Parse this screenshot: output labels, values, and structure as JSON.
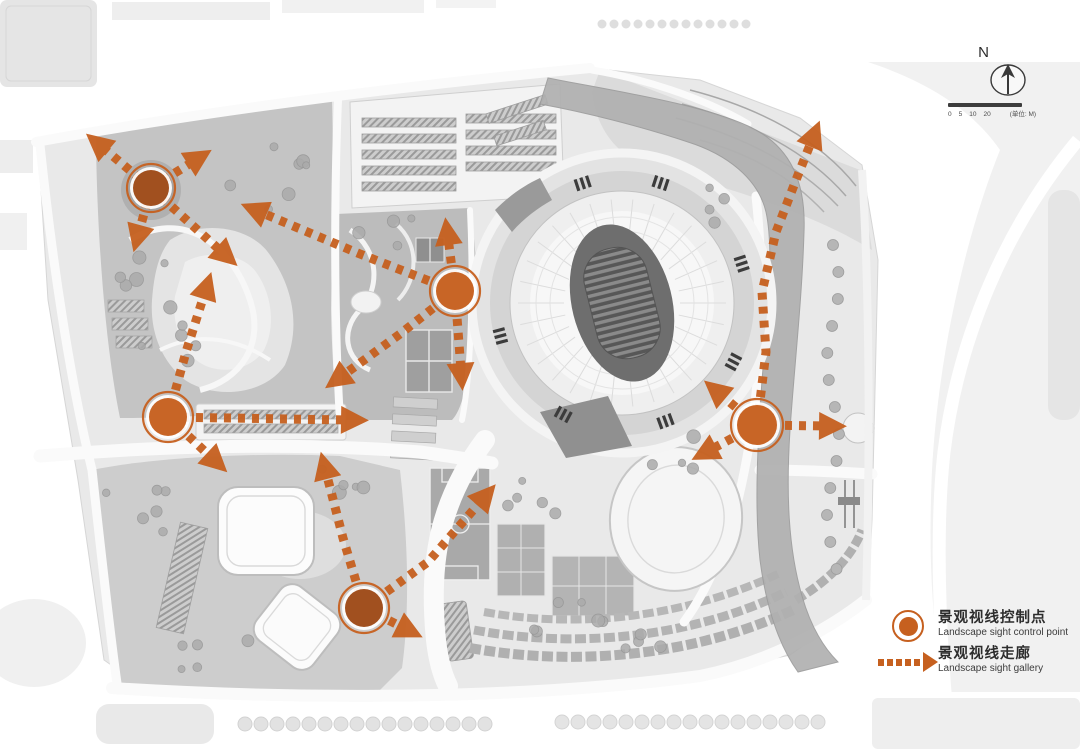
{
  "compass": {
    "north_label": "N"
  },
  "scale_bar": {
    "ticks": [
      "0",
      "5",
      "10",
      "20"
    ],
    "unit_label": "(单位: M)"
  },
  "legend": {
    "items": [
      {
        "id": "control-point",
        "symbol": "circle",
        "label_cn": "景观视线控制点",
        "label_en": "Landscape sight control point"
      },
      {
        "id": "sight-gallery",
        "symbol": "dashed-arrow",
        "label_cn": "景观视线走廊",
        "label_en": "Landscape sight gallery"
      }
    ]
  },
  "colors": {
    "accent_orange": "#c6601f",
    "accent_orange_dark": "#9e4a18",
    "map_gray": "#c8c8c8",
    "river_gray": "#b0b0b0",
    "page_bg": "#ffffff"
  },
  "map": {
    "control_points": [
      {
        "id": "CP1",
        "x": 151,
        "y": 188,
        "r": 18,
        "shade": "dark"
      },
      {
        "id": "CP2",
        "x": 455,
        "y": 291,
        "r": 19,
        "shade": "normal"
      },
      {
        "id": "CP3",
        "x": 168,
        "y": 417,
        "r": 19,
        "shade": "normal"
      },
      {
        "id": "CP4",
        "x": 364,
        "y": 608,
        "r": 19,
        "shade": "dark"
      },
      {
        "id": "CP5",
        "x": 757,
        "y": 425,
        "r": 20,
        "shade": "normal"
      }
    ],
    "sight_corridors": [
      {
        "id": "c1",
        "path": [
          [
            151,
            188
          ],
          [
            102,
            147
          ]
        ],
        "arrow_end": true
      },
      {
        "id": "c2",
        "path": [
          [
            151,
            188
          ],
          [
            194,
            161
          ]
        ],
        "arrow_end": true
      },
      {
        "id": "c3",
        "path": [
          [
            151,
            188
          ],
          [
            139,
            232
          ]
        ],
        "arrow_end": true
      },
      {
        "id": "c4",
        "path": [
          [
            151,
            188
          ],
          [
            222,
            252
          ]
        ],
        "arrow_end": true
      },
      {
        "id": "c5",
        "path": [
          [
            455,
            291
          ],
          [
            448,
            238
          ]
        ],
        "arrow_end": true
      },
      {
        "id": "c6",
        "path": [
          [
            455,
            291
          ],
          [
            461,
            370
          ]
        ],
        "arrow_end": true
      },
      {
        "id": "c7",
        "path": [
          [
            455,
            291
          ],
          [
            400,
            334
          ],
          [
            342,
            376
          ]
        ],
        "arrow_end": true
      },
      {
        "id": "c8",
        "path": [
          [
            455,
            291
          ],
          [
            360,
            254
          ],
          [
            260,
            212
          ]
        ],
        "arrow_end": true
      },
      {
        "id": "c9",
        "path": [
          [
            168,
            417
          ],
          [
            186,
            352
          ],
          [
            205,
            292
          ]
        ],
        "arrow_end": true
      },
      {
        "id": "c10",
        "path": [
          [
            168,
            417
          ],
          [
            348,
            420
          ]
        ],
        "arrow_end": true
      },
      {
        "id": "c11",
        "path": [
          [
            168,
            417
          ],
          [
            212,
            458
          ]
        ],
        "arrow_end": true
      },
      {
        "id": "c12",
        "path": [
          [
            364,
            608
          ],
          [
            343,
            538
          ],
          [
            326,
            472
          ]
        ],
        "arrow_end": true
      },
      {
        "id": "c13",
        "path": [
          [
            364,
            608
          ],
          [
            428,
            562
          ],
          [
            482,
            500
          ]
        ],
        "arrow_end": true
      },
      {
        "id": "c14",
        "path": [
          [
            364,
            608
          ],
          [
            404,
            628
          ]
        ],
        "arrow_end": true
      },
      {
        "id": "c15",
        "path": [
          [
            757,
            425
          ],
          [
            826,
            426
          ]
        ],
        "arrow_end": true
      },
      {
        "id": "c16",
        "path": [
          [
            757,
            425
          ],
          [
            710,
            450
          ]
        ],
        "arrow_end": true
      },
      {
        "id": "c17",
        "path": [
          [
            757,
            425
          ],
          [
            720,
            394
          ]
        ],
        "arrow_end": true
      },
      {
        "id": "c18",
        "path": [
          [
            757,
            425
          ],
          [
            766,
            352
          ],
          [
            762,
            292
          ],
          [
            776,
            232
          ],
          [
            796,
            180
          ],
          [
            812,
            140
          ]
        ],
        "arrow_end": true
      }
    ]
  }
}
